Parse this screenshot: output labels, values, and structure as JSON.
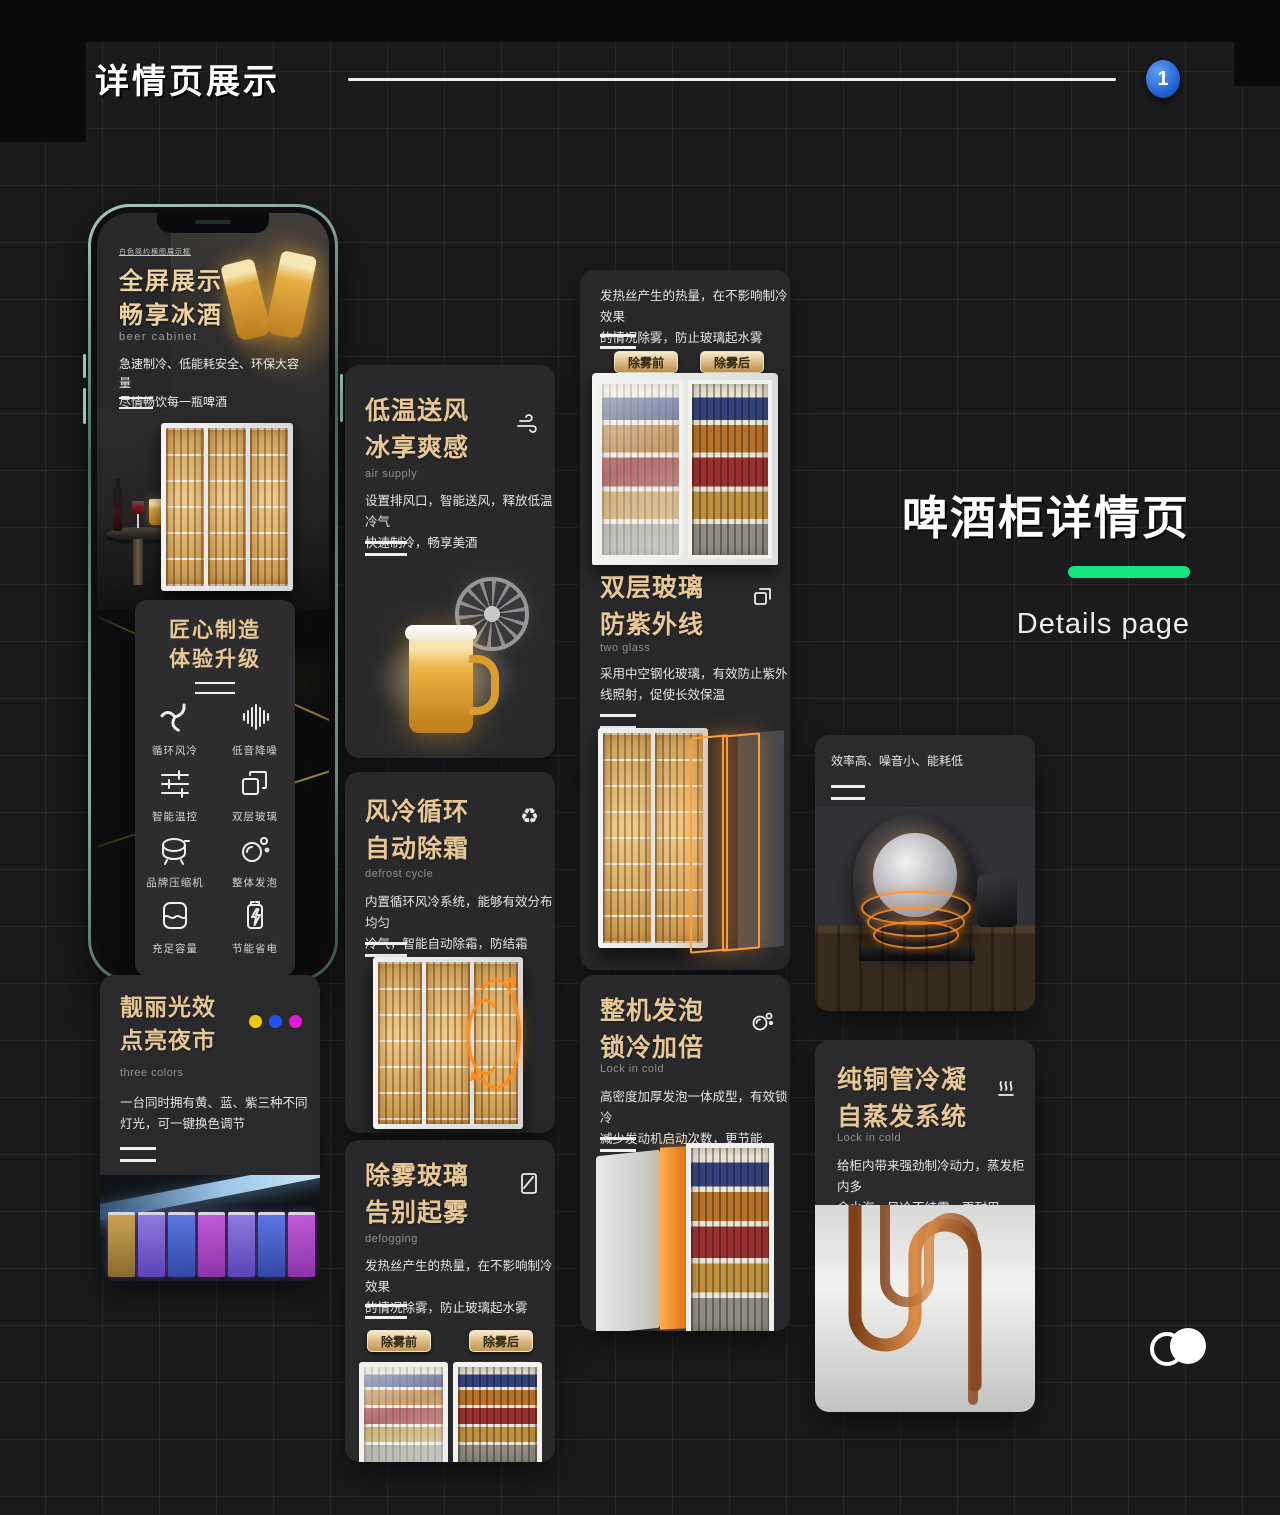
{
  "theme": {
    "gold": "#e7c795",
    "green_bar": "#15e57d",
    "badge_blue": "#1c5ecf",
    "orange_glow": "#ff8c1e"
  },
  "header": {
    "title": "详情页展示",
    "badge": "1"
  },
  "side": {
    "title": "啤酒柜详情页",
    "subtitle": "Details page"
  },
  "phone": {
    "top_note": "白色简约横图展示框",
    "title1": "全屏展示",
    "title2": "畅享冰酒",
    "subtitle": "beer cabinet",
    "body1": "急速制冷、低能耗安全、环保大容量",
    "body2": "尽情畅饮每一瓶啤酒"
  },
  "craft": {
    "title1": "匠心制造",
    "title2": "体验升级",
    "features": [
      {
        "icon": "fan-swirl-icon",
        "label": "循环风冷"
      },
      {
        "icon": "sound-bars-icon",
        "label": "低音降噪"
      },
      {
        "icon": "sliders-icon",
        "label": "智能温控"
      },
      {
        "icon": "double-glass-icon",
        "label": "双层玻璃"
      },
      {
        "icon": "compressor-icon",
        "label": "品牌压缩机"
      },
      {
        "icon": "bubbles-icon",
        "label": "整体发泡"
      },
      {
        "icon": "capacity-icon",
        "label": "充足容量"
      },
      {
        "icon": "battery-bolt-icon",
        "label": "节能省电"
      }
    ]
  },
  "light": {
    "title1": "靓丽光效",
    "title2": "点亮夜市",
    "subtitle": "three colors",
    "body1": "一台同时拥有黄、蓝、紫三种不同",
    "body2": "灯光，可一键换色调节",
    "dots": [
      "#f2c40c",
      "#2453f5",
      "#e316d6"
    ]
  },
  "air": {
    "title1": "低温送风",
    "title2": "冰享爽感",
    "subtitle": "air supply",
    "body1": "设置排风口，智能送风，释放低温冷气",
    "body2": "快速制冷，畅享美酒"
  },
  "defrost": {
    "title1": "风冷循环",
    "title2": "自动除霜",
    "subtitle": "defrost cycle",
    "body1": "内置循环风冷系统，能够有效分布均匀",
    "body2": "冷气，智能自动除霜，防结霜",
    "recycle_icon": "♻"
  },
  "defog": {
    "title1": "除雾玻璃",
    "title2": "告别起雾",
    "subtitle": "defogging",
    "body1": "发热丝产生的热量，在不影响制冷效果",
    "body2": "的情况除雾，防止玻璃起水雾",
    "btn_before": "除雾前",
    "btn_after": "除雾后"
  },
  "uv": {
    "body1": "发热丝产生的热量，在不影响制冷效果",
    "body2": "的情况除雾，防止玻璃起水雾",
    "btn_before": "除雾前",
    "btn_after": "除雾后"
  },
  "glass": {
    "title1": "双层玻璃",
    "title2": "防紫外线",
    "subtitle": "two glass",
    "body1": "采用中空钢化玻璃，有效防止紫外",
    "body2": "线照射，促使长效保温"
  },
  "foam": {
    "title1": "整机发泡",
    "title2": "锁冷加倍",
    "subtitle": "Lock in cold",
    "body1": "高密度加厚发泡一体成型，有效锁冷",
    "body2": "减少发动机启动次数，更节能"
  },
  "compressor": {
    "caption": "效率高、噪音小、能耗低"
  },
  "copper": {
    "title1": "纯铜管冷凝",
    "title2": "自蒸发系统",
    "subtitle": "Lock in cold",
    "body1": "给柜内带来强劲制冷动力，蒸发柜内多",
    "body2": "余水汽，风冷不结霜，更耐用"
  }
}
